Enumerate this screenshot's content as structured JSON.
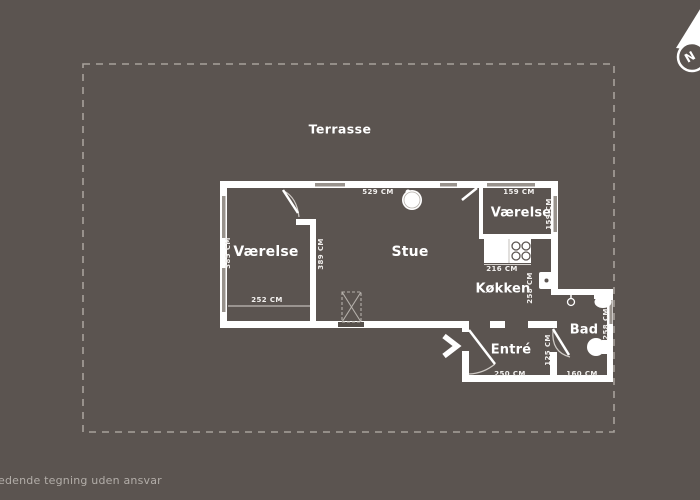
{
  "meta": {
    "kind": "floor-plan"
  },
  "colors": {
    "background": "#5b5450",
    "wall": "#ffffff",
    "terrace_outline": "#a7a19b",
    "dimension_text": "#f3f1ef",
    "footer_text": "#b2ada8"
  },
  "compass": {
    "label": "N"
  },
  "terrace": {
    "label": "Terrasse"
  },
  "rooms": {
    "bedroom_left": "Værelse",
    "living_room": "Stue",
    "bedroom_right": "Værelse",
    "kitchen": "Køkken",
    "hall": "Entré",
    "bathroom": "Bad"
  },
  "dimensions": {
    "bedroom_left_height": "385 CM",
    "bedroom_left_inner_height": "389 CM",
    "bedroom_left_width": "252 CM",
    "living_room_width": "529 CM",
    "bedroom_right_width": "159 CM",
    "bedroom_right_height": "159 CM",
    "kitchen_width": "216 CM",
    "kitchen_height": "258 CM",
    "bathroom_height": "258 CM",
    "hall_height": "125 CM",
    "hall_width": "250 CM",
    "bathroom_width": "160 CM"
  },
  "footer": {
    "disclaimer": "edende tegning uden ansvar"
  }
}
